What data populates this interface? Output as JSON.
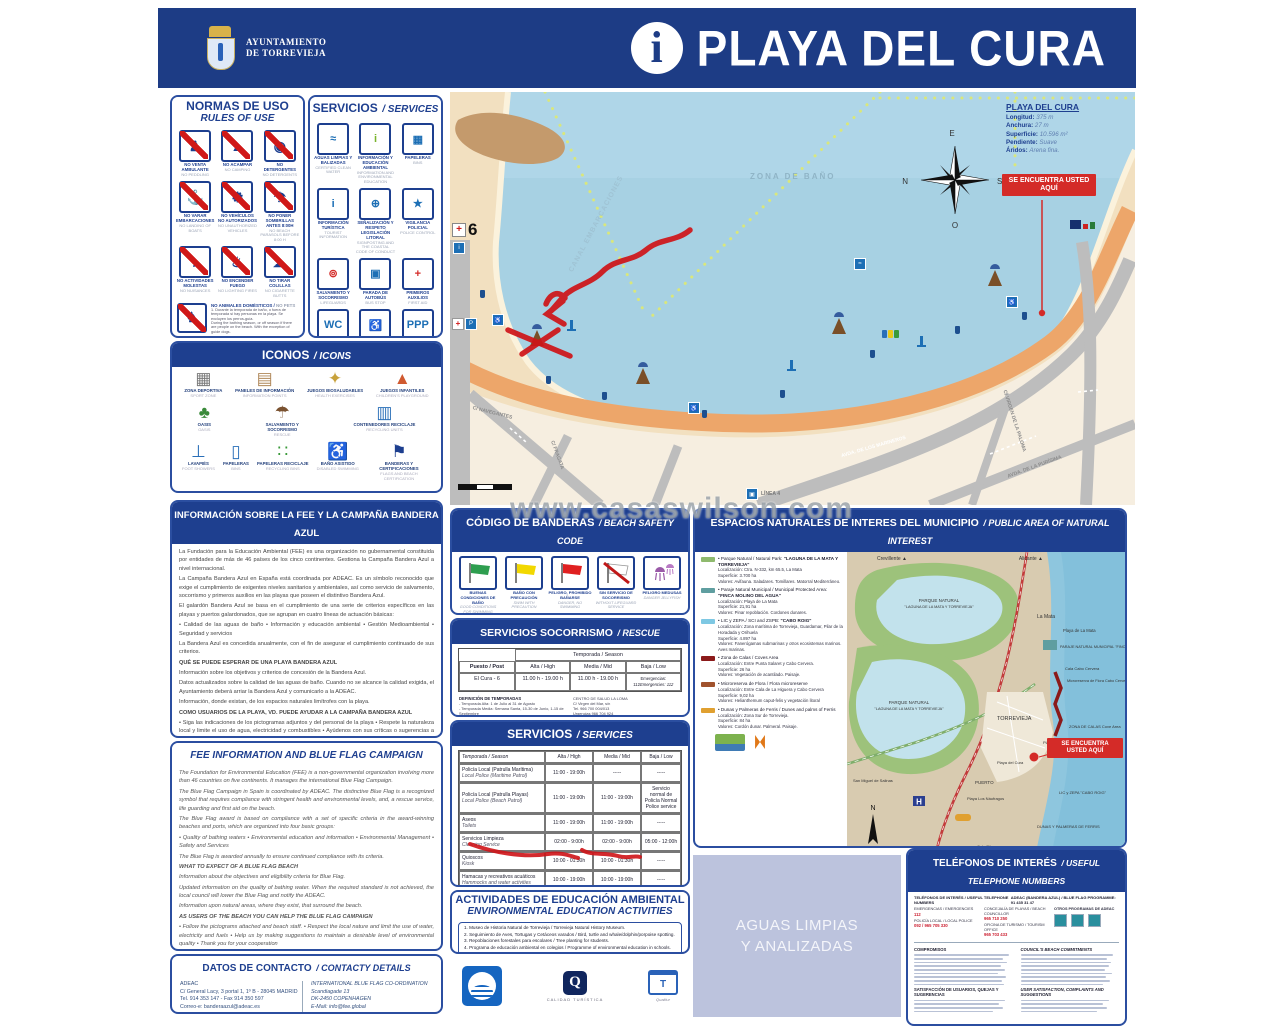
{
  "header": {
    "municipality_line1": "AYUNTAMIENTO",
    "municipality_line2": "DE TORREVIEJA",
    "info_symbol": "i",
    "title": "PLAYA DEL CURA"
  },
  "watermark": "www.casaswilson.com",
  "normas": {
    "title": "NORMAS DE USO",
    "subtitle": "RULES OF USE",
    "items": [
      {
        "es": "NO VENTA AMBULANTE",
        "en": "NO PEDDLING",
        "glyph": "♟"
      },
      {
        "es": "NO ACAMPAR",
        "en": "NO CAMPING",
        "glyph": "▲"
      },
      {
        "es": "NO DETERGENTES",
        "en": "NO DETERGENTS",
        "glyph": "◉"
      },
      {
        "es": "NO VARAR EMBARCACIONES",
        "en": "NO LANDING OF BOATS",
        "glyph": "⚓"
      },
      {
        "es": "NO VEHÍCULOS NO AUTORIZADOS",
        "en": "NO UNAUTHORIZED VEHICLES",
        "glyph": "⚙"
      },
      {
        "es": "NO PONER SOMBRILLAS ANTES 8:00H",
        "en": "NO BEACH PARASOLS BEFORE 8:00 H",
        "glyph": "☂"
      },
      {
        "es": "NO ACTIVIDADES MOLESTAS",
        "en": "NO NUISANCES",
        "glyph": "♪"
      },
      {
        "es": "NO ENCENDER FUEGO",
        "en": "NO LIGHTING FIRES",
        "glyph": "♨"
      },
      {
        "es": "NO TIRAR COLILLAS",
        "en": "NO CIGARETTE BUTTS",
        "glyph": "☁"
      }
    ],
    "pets": {
      "es": "NO ANIMALES DOMÉSTICOS",
      "en": "NO PETS",
      "glyph": "♞",
      "note_es": "1. Durante la temporada de baño, o fuera de temporada si hay personas en la playa. Se excluyen los perros-guía.",
      "note_en": "During the bathing season, or off season if there are people on the beach. With the exception of guide dogs."
    },
    "fishing": {
      "es": "PROHIBIDO PESCAR",
      "en": "FISHING PROHIBITED",
      "glyph": "Ψ",
      "note_es": "1. Durante la temporada de baño principalmente entre 21 y 8 horas si no hay bañistas. 2. Prohibida la pesca submarina en las zonas de baño.",
      "note_en": "Spearfishing in bathing zones prohibited."
    }
  },
  "servicios_panel": {
    "title": "SERVICIOS",
    "subtitle": "SERVICES",
    "items": [
      {
        "es": "AGUAS LIMPIAS Y BALIZADAS",
        "en": "CERTIFIED CLEAN WATER",
        "glyph": "≈",
        "color": "#1d6fb5"
      },
      {
        "es": "INFORMACIÓN Y EDUCACIÓN AMBIENTAL",
        "en": "INFORMATION AND ENVIRONMENTAL EDUCATION",
        "glyph": "i",
        "color": "#7ab42d"
      },
      {
        "es": "PAPELERAS",
        "en": "BINS",
        "glyph": "▦",
        "color": "#1d6fb5"
      },
      {
        "es": "INFORMACIÓN TURÍSTICA",
        "en": "TOURIST INFORMATION",
        "glyph": "i",
        "color": "#1d6fb5"
      },
      {
        "es": "SEÑALIZACIÓN Y RESPETO LEGISLACIÓN LITORAL",
        "en": "SIGNPOSTING AND THE COASTAL CODE OF CONDUCT",
        "glyph": "⊕",
        "color": "#1d6fb5"
      },
      {
        "es": "VIGILANCIA POLICIAL",
        "en": "POLICE CONTROL",
        "glyph": "★",
        "color": "#1d6fb5"
      },
      {
        "es": "SALVAMENTO Y SOCORRISMO",
        "en": "LIFEGUARDS",
        "glyph": "⊚",
        "color": "#d42b28"
      },
      {
        "es": "PARADA DE AUTOBÚS",
        "en": "BUS STOP",
        "glyph": "▣",
        "color": "#1d6fb5"
      },
      {
        "es": "PRIMEROS AUXILIOS",
        "en": "FIRST AID",
        "glyph": "+",
        "color": "#d42b28"
      },
      {
        "es": "ASEOS ADAPTADOS",
        "en": "DISABLED TOILETS",
        "glyph": "WC",
        "color": "#1d6fb5"
      },
      {
        "es": "ACCESOS FÁCILES Y SEGUROS",
        "en": "SAFE AND EASY ACCESS",
        "glyph": "♿",
        "color": "#1d6fb5"
      },
      {
        "es": "APARCAMIENTOS RESERVADOS",
        "en": "RESERVED PARKING",
        "glyph": "PPP",
        "color": "#1d6fb5"
      }
    ]
  },
  "iconos": {
    "title": "ICONOS",
    "subtitle": "ICONS",
    "row1": [
      {
        "es": "ZONA DEPORTIVA",
        "en": "SPORT ZONE",
        "glyph": "▦",
        "color": "#7a7a7a"
      },
      {
        "es": "PANELES DE INFORMACIÓN",
        "en": "INFORMATION POINTS",
        "glyph": "▤",
        "color": "#b0885a"
      },
      {
        "es": "JUEGOS BIOSALUDABLES",
        "en": "HEALTH EXERCISES",
        "glyph": "✦",
        "color": "#c8a23c"
      },
      {
        "es": "JUEGOS INFANTILES",
        "en": "CHILDREN'S PLAYGROUND",
        "glyph": "▲",
        "color": "#d05a30"
      }
    ],
    "row2": [
      {
        "es": "OASIS",
        "en": "OASIS",
        "glyph": "♣",
        "color": "#3a8a3a"
      },
      {
        "es": "SALVAMENTO Y SOCORRISMO",
        "en": "RESCUE",
        "glyph": "☂",
        "color": "#7a5230"
      },
      {
        "es": "CONTENEDORES RECICLAJE",
        "en": "RECYCLING UNITS",
        "glyph": "▥",
        "color": "#2a6fb8"
      }
    ],
    "row3": [
      {
        "es": "LAVAPIÉS",
        "en": "FOOT SHOWERS",
        "glyph": "⊥",
        "color": "#2a6fb8"
      },
      {
        "es": "PAPELERAS",
        "en": "BINS",
        "glyph": "▯",
        "color": "#2a6fb8"
      },
      {
        "es": "PAPELERAS RECICLAJE",
        "en": "RECYCLING BINS",
        "glyph": "∷",
        "color": "#3a9a3a"
      },
      {
        "es": "BAÑO ASISTIDO",
        "en": "DISABLED SWIMMING",
        "glyph": "♿",
        "color": "#2a6fb8"
      },
      {
        "es": "BANDERAS Y CERTIFICACIONES",
        "en": "FLAGS AND BEACH CERTIFICATION",
        "glyph": "⚑",
        "color": "#1d3f8f"
      }
    ]
  },
  "info_fee": {
    "title": "INFORMACIÓN SOBRE LA FEE Y LA CAMPAÑA BANDERA AZUL",
    "blocks": [
      {
        "text": "La Fundación para la Educación Ambiental (FEE) es una organización no gubernamental constituida por entidades de más de 46 países de los cinco continentes. Gestiona la Campaña Bandera Azul a nivel internacional.",
        "fw": "normal"
      },
      {
        "text": "La Campaña Bandera Azul en España está coordinada por ADEAC. Es un símbolo reconocido que exige el cumplimiento de exigentes niveles sanitarios y ambientales, así como servicio de salvamento, socorrismo y primeros auxilios en las playas que poseen el distintivo Bandera Azul.",
        "fw": "normal"
      },
      {
        "text": "El galardón Bandera Azul se basa en el cumplimiento de una serie de criterios específicos en las playas y puertos galardonados, que se agrupan en cuatro líneas de actuación básicas:",
        "fw": "normal"
      },
      {
        "text": "• Calidad de las aguas de baño  • Información y educación ambiental  • Gestión Medioambiental  • Seguridad y servicios",
        "fw": "normal"
      },
      {
        "text": "La Bandera Azul es concedida anualmente, con el fin de asegurar el cumplimiento continuado de sus criterios.",
        "fw": "normal"
      },
      {
        "text": "QUÉ SE PUEDE ESPERAR DE UNA PLAYA BANDERA AZUL",
        "fw": "bold"
      },
      {
        "text": "Información sobre los objetivos y criterios de concesión de la Bandera Azul.",
        "fw": "normal"
      },
      {
        "text": "Datos actualizados sobre la calidad de las aguas de baño. Cuando no se alcance la calidad exigida, el Ayuntamiento deberá arriar la Bandera Azul y comunicarlo a la ADEAC.",
        "fw": "normal"
      },
      {
        "text": "Información, donde existan, de los espacios naturales limítrofes con la playa.",
        "fw": "normal"
      },
      {
        "text": "COMO USUARIOS DE LA PLAYA, VD. PUEDE AYUDAR A LA CAMPAÑA BANDERA AZUL",
        "fw": "bold"
      },
      {
        "text": "• Siga las indicaciones de los pictogramas adjuntos y del personal de la playa  • Respete la naturaleza local y limite el uso de agua, electricidad y combustibles  • Ayúdenos con sus críticas o sugerencias a mantener el nivel de calidad ambiental deseable  • Gracias por su colaboración",
        "fw": "normal"
      }
    ]
  },
  "fee_en": {
    "title": "FEE INFORMATION AND BLUE FLAG CAMPAIGN",
    "blocks": [
      {
        "text": "The Foundation for Environmental Education (FEE) is a non-governmental organization involving more than 46 countries on five continents. It manages the international Blue Flag Campaign.",
        "fw": "normal"
      },
      {
        "text": "The Blue Flag Campaign in Spain is coordinated by ADEAC. The distinctive Blue Flag is a recognized symbol that requires compliance with stringent health and environmental levels, and, a rescue service, life guarding and first aid on the beach.",
        "fw": "normal"
      },
      {
        "text": "The Blue Flag award is based on compliance with a set of specific criteria in the award-winning beaches and ports, which are organized into four basic groups:",
        "fw": "normal"
      },
      {
        "text": "• Quality of bathing waters  • Environmental education and information  • Environmental Management  • Safety and Services",
        "fw": "normal"
      },
      {
        "text": "The Blue Flag is awarded annually to ensure continued compliance with its criteria.",
        "fw": "normal"
      },
      {
        "text": "WHAT TO EXPECT OF A BLUE FLAG BEACH",
        "fw": "bold"
      },
      {
        "text": "Information about the objectives and eligibility criteria for Blue Flag.",
        "fw": "normal"
      },
      {
        "text": "Updated information on the quality of bathing water. When the required standard is not achieved, the local council will lower the Blue Flag and notify the ADEAC.",
        "fw": "normal"
      },
      {
        "text": "Information upon natural areas, where they exist, that surround the beach.",
        "fw": "normal"
      },
      {
        "text": "AS USERS OF THE BEACH YOU CAN HELP THE BLUE FLAG CAMPAIGN",
        "fw": "bold"
      },
      {
        "text": "• Follow the pictograms attached and beach staff.  • Respect the local nature and limit the use of water, electricity and fuels  • Help us by making suggestions to maintain a desirable level of environmental quality  • Thank you for your cooperation",
        "fw": "normal"
      }
    ]
  },
  "contacto": {
    "title": "DATOS DE CONTACTO",
    "subtitle": "CONTACTY DETAILS",
    "left": [
      "ADEAC",
      "C/ General Lacy, 3 portal 1, 1º B - 28045 MADRID",
      "Tel. 914 353 147 - Fax 914 350 597",
      "Correo-e: banderaazul@adeac.es"
    ],
    "right": [
      "INTERNATIONAL BLUE FLAG CO-ORDINATION",
      "Scandiagade 13",
      "DK-2450 COPENHAGEN",
      "E-Mail: info@fee.global"
    ]
  },
  "map": {
    "zona_bano": "ZONA DE BAÑO",
    "canal": "CANAL EMBARCACIONES",
    "streets": [
      "C/ NAVEGANTES",
      "C/ FRAGATA",
      "AVDA. DE LOS MARINEROS",
      "C/ VIRGEN DE LA PALOMA",
      "AVDA. DE LA PURÍSIMA"
    ],
    "linea": "LÍNEA 4",
    "marker6": "6",
    "compass": {
      "n": "N",
      "e": "E",
      "s": "S",
      "o": "O"
    },
    "stats": {
      "title": "PLAYA DEL CURA",
      "rows": [
        {
          "k": "Longitud:",
          "v": "375 m"
        },
        {
          "k": "Anchura:",
          "v": "27 m"
        },
        {
          "k": "Superficie:",
          "v": "10.596 m²"
        },
        {
          "k": "Pendiente:",
          "v": "Suave"
        },
        {
          "k": "Áridos:",
          "v": "Arena fina."
        }
      ]
    },
    "you_are_here": "SE ENCUENTRA USTED AQUÍ"
  },
  "banderas": {
    "title": "CÓDIGO DE BANDERAS",
    "subtitle": "BEACH SAFETY CODE",
    "flags": [
      {
        "es": "BUENAS CONDICIONES DE BAÑO",
        "en": "GOOD CONDITIONS FOR SWIMMING"
      },
      {
        "es": "BAÑO CON PRECAUCIÓN",
        "en": "SWIM WITH PRECAUTION"
      },
      {
        "es": "PELIGRO, PROHIBIDO BAÑARSE",
        "en": "DANGER, NO SWIMMING"
      },
      {
        "es": "SIN SERVICIO DE SOCORRISMO",
        "en": "WITHOUT LIFEGUARD SERVICE"
      },
      {
        "es": "PELIGRO MEDUSAS",
        "en": "DANGER JELLYFISH"
      }
    ]
  },
  "socorrismo": {
    "title": "SERVICIOS SOCORRISMO",
    "subtitle": "RESCUE",
    "season_header": "Temporada / Season",
    "col_post": "Puesto / Post",
    "col_alta": "Alta / High",
    "col_media": "Media / Mid",
    "col_baja": "Baja / Low",
    "row": {
      "post": "El Cura - 6",
      "alta": "11.00 h - 19.00 h",
      "media": "11.00 h - 19.00 h",
      "baja1": "Emergencias: 112",
      "baja2": "Emergencies: 112"
    },
    "def_es_title": "DEFINICIÓN DE TEMPORADAS",
    "def_es": [
      "- Temporada Alta: 1 de Julio al 31 de Agosto",
      "- Temporada Media: Semana Santa, 15-30 de Junio, 1-15 de Septiembre",
      "- Temporada Baja: Resto del año"
    ],
    "def_en_title": "SEASONS TIMETABLE",
    "def_en": [
      "- High Season: from 1st of July to 31st of August",
      "- Mid Season: Easter, 15th-30th of June, 1st-15th September",
      "- Low Season: Rest of the year"
    ],
    "salud": [
      "CENTRO DE SALUD LA LOMA",
      "C/ Virgen del Mar, s/n",
      "Tel. 966 700 004/013",
      "Urgencias 966 704 924",
      "GPS: 37°58'54\"N - 0°40'29\"W",
      "HOSPITAL DE TORREVIEJA",
      "Ctra. CV-95, s/n",
      "Tel. 965 721 400",
      "GPS: 37°58'46\"N - 0°43'05\"W"
    ]
  },
  "servicios_tabla": {
    "title": "SERVICIOS",
    "subtitle": "SERVICES",
    "col_temporada": "Temporada / Season",
    "col_alta": "Alta / High",
    "col_media": "Media / Mid",
    "col_baja": "Baja / Low",
    "rows": [
      {
        "es": "Policía Local (Patrulla Marítima)",
        "en": "Local Police (Maritime Patrol)",
        "alta": "11:00 - 19:00h",
        "media": "-----",
        "baja": "-----"
      },
      {
        "es": "Policía Local (Patrulla Playas)",
        "en": "Local Police (Beach Patrol)",
        "alta": "11:00 - 19:00h",
        "media": "11:00 - 19:00h",
        "baja": "Servicio normal de Policía Normal Police service"
      },
      {
        "es": "Aseos",
        "en": "Toilets",
        "alta": "11:00 - 19:00h",
        "media": "11:00 - 19:00h",
        "baja": "-----"
      },
      {
        "es": "Servicios Limpieza",
        "en": "Cleaning Service",
        "alta": "02:00 - 9:00h",
        "media": "02:00 - 9:00h",
        "baja": "05:00 - 12:00h"
      },
      {
        "es": "Quioscos",
        "en": "Kiosk",
        "alta": "10:00 - 01:30h",
        "media": "10:00 - 01:30h",
        "baja": "-----"
      },
      {
        "es": "Hamacas y recreativos acuáticos",
        "en": "Hammocks and water activities",
        "alta": "10:00 - 19:00h",
        "media": "10:00 - 19:00h",
        "baja": "-----"
      }
    ],
    "def_es_title": "DEFINICIÓN DE TEMPORADAS",
    "def_es": [
      "- Temporada Alta: 1 de Julio al 31 de Agosto",
      "- Temporada Media: Semana Santa, 15-30 de Junio, 1-15 de Septiembre",
      "- Temporada Baja: Resto del año"
    ],
    "def_en_title": "DEFINITION OF SEASONS",
    "def_en": [
      "- High Season: from 1st of July to 31st of August",
      "- Mid Season: Easter, 15th-30th June, 1st-15 of September",
      "- Low Season: Rest of the year"
    ],
    "footer": "Carta de Servicios disponible en la web del Ayuntamiento / Selection of services available on the local council website"
  },
  "actividades": {
    "title": "ACTIVIDADES DE EDUCACIÓN AMBIENTAL",
    "subtitle": "ENVIRONMENTAL EDUCATION ACTIVITIES",
    "lines": [
      "1. Museo de Historia Natural de Torrevieja / Torrevieja Natural History Museum.",
      "2. Seguimiento de Aves, Tortugas y Cetáceos varados / Bird, turtle and whale/dolphin/porpoise spotting.",
      "3. Repoblaciones forestales para escolares / Tree planting for students.",
      "4. Programa de educación ambiental en colegios / Programme of environmental education in schools.",
      "5. Visitas escolares al Parque Natural / School visits to the Natural Park."
    ]
  },
  "logos": {
    "blue_flag": "Bandera Azul",
    "q_label": "CALIDAD TURÍSTICA",
    "t_label": "Qualitur"
  },
  "espacios": {
    "title": "ESPACIOS NATURALES DE INTERES DEL MUNICIPIO",
    "subtitle": "PUBLIC AREA OF NATURAL INTEREST",
    "items": [
      {
        "sw": "#8fba6e",
        "head": "• Parque Natural / Natural Park:",
        "name": "\"LAGUNA DE LA MATA Y TORREVIEJA\"",
        "loc": "Localización: Ctra. N-332, km 65.5, La Mata",
        "sup": "Superficie: 3.700 ha",
        "val": "Valores: Avifauna. Saladares. Tomillares. Matorral Mediterráneo."
      },
      {
        "sw": "#5f9ea0",
        "head": "• Paraje Natural Municipal / Municipal Protected Area:",
        "name": "\"FINCA MOLINO DEL AGUA\"",
        "loc": "Localización: Playa de La Mata",
        "sup": "Superficie: 21,91 ha",
        "val": "Valores: Pinar repoblación. Cordones dunares."
      },
      {
        "sw": "#7ec8e3",
        "head": "• LIC y ZEPA / SCI and ZSPB:",
        "name": "\"CABO ROIG\"",
        "loc": "Localización: Zona marítima de Torrevieja, Guardamar, Pilar de la Horadada y Orihuela",
        "sup": "Superficie: 4.897 ha",
        "val": "Valores: Fanerógamas submarinas y otros ecosistemas marinos. Aves marinas."
      },
      {
        "sw": "#8b1a1a",
        "head": "• Zona de Calas / Coves Area",
        "name": "",
        "loc": "Localización: Entre Punta Salaret y Cabo Cervera.",
        "sup": "Superficie: 26 ha",
        "val": "Valores: Vegetación de acantilado. Paisaje."
      },
      {
        "sw": "#a0522d",
        "head": "• Microreserva de Flora / Flora microreserve",
        "name": "",
        "loc": "Localización: Entre Cala de La Higuera y Cabo Cervera",
        "sup": "Superficie: 9,02 ha",
        "val": "Valores: Helianthemum caput-felis y vegetación litoral"
      },
      {
        "sw": "#e0a030",
        "head": "• Dunas y Palmeras de Ferris / Dunes and palms of Ferris",
        "name": "",
        "loc": "Localización: Zona Sur de Torrevieja.",
        "sup": "Superficie: 84 ha",
        "val": "Valores: Cordón dunar. Palmeral. Paisaje."
      }
    ],
    "map_labels": {
      "crevillente": "Crevillente ▲",
      "alicante": "Alicante ▲",
      "pn1": "PARQUE NATURAL",
      "pn1b": "\"LAGUNA DE LA MATA Y TORREVIEJA\"",
      "pn2": "PARQUE NATURAL",
      "pn2b": "\"LAGUNA DE LA MATA Y TORREVIEJA\"",
      "lamata": "La Mata",
      "playamata": "Playa de La Mata",
      "finca": "PARAJE NATURAL MUNICIPAL \"FINCA MOLINO DEL AGUA\"",
      "cervera": "Cala Cabo Cervera",
      "micro": "Microreserva de Flora Cabo Cervera",
      "torrevieja": "TORREVIEJA",
      "calas": "ZONA DE CALAS Cove Area",
      "locos": "Playa de Los Locos",
      "cura": "Playa del Cura",
      "puerto": "PUERTO",
      "naufragos": "Playa Los Náufragos",
      "sanmiguel": "San Miguel de Salinas",
      "caboroig": "LIC y ZEPA \"CABO ROIG\"",
      "dunas": "DUNAS Y PALMERAS DE FERRIS",
      "piteras": "Cala Piteras",
      "cartagena": "Cartagena ▼",
      "hosp": "H",
      "you_are_here": "SE ENCUENTRA USTED AQUÍ"
    }
  },
  "aguas": {
    "line1": "AGUAS LIMPIAS",
    "line2": "Y ANALIZADAS"
  },
  "telefonos": {
    "title": "TELÉFONOS DE INTERÉS",
    "subtitle": "USEFUL TELEPHONE NUMBERS",
    "topline_left": "TELÉFONOS DE INTERÉS / USEFUL TELEPHONE NUMBERS",
    "topline_right": "ADEAC (BANDERA AZUL) / BLUE FLAG PROGRAMME: 91 435 31 47",
    "col1": [
      {
        "k": "EMERGENCIAS / EMERGENCIES",
        "v": "112"
      },
      {
        "k": "POLICÍA LOCAL / LOCAL POLICE",
        "v": "092 / 965 705 330"
      }
    ],
    "col2": [
      {
        "k": "CONCEJALÍA DE PLAYAS / BEACH COUNCILLOR",
        "v": "965 710 250"
      },
      {
        "k": "OFICINA DE TURISMO / TOURISM OFFICE",
        "v": "965 703 433"
      }
    ],
    "otros": "OTROS PROGRAMAS DE ADEAC",
    "h_es": "COMPROMISOS",
    "h_en": "COUNCIL'S BEACH COMMITMENTS",
    "h2_es": "SATISFACCIÓN DE USUARIOS, QUEJAS Y SUGERENCIAS",
    "h2_en": "USER SATISFACTION, COMPLAINTS AND SUGGESTIONS"
  }
}
